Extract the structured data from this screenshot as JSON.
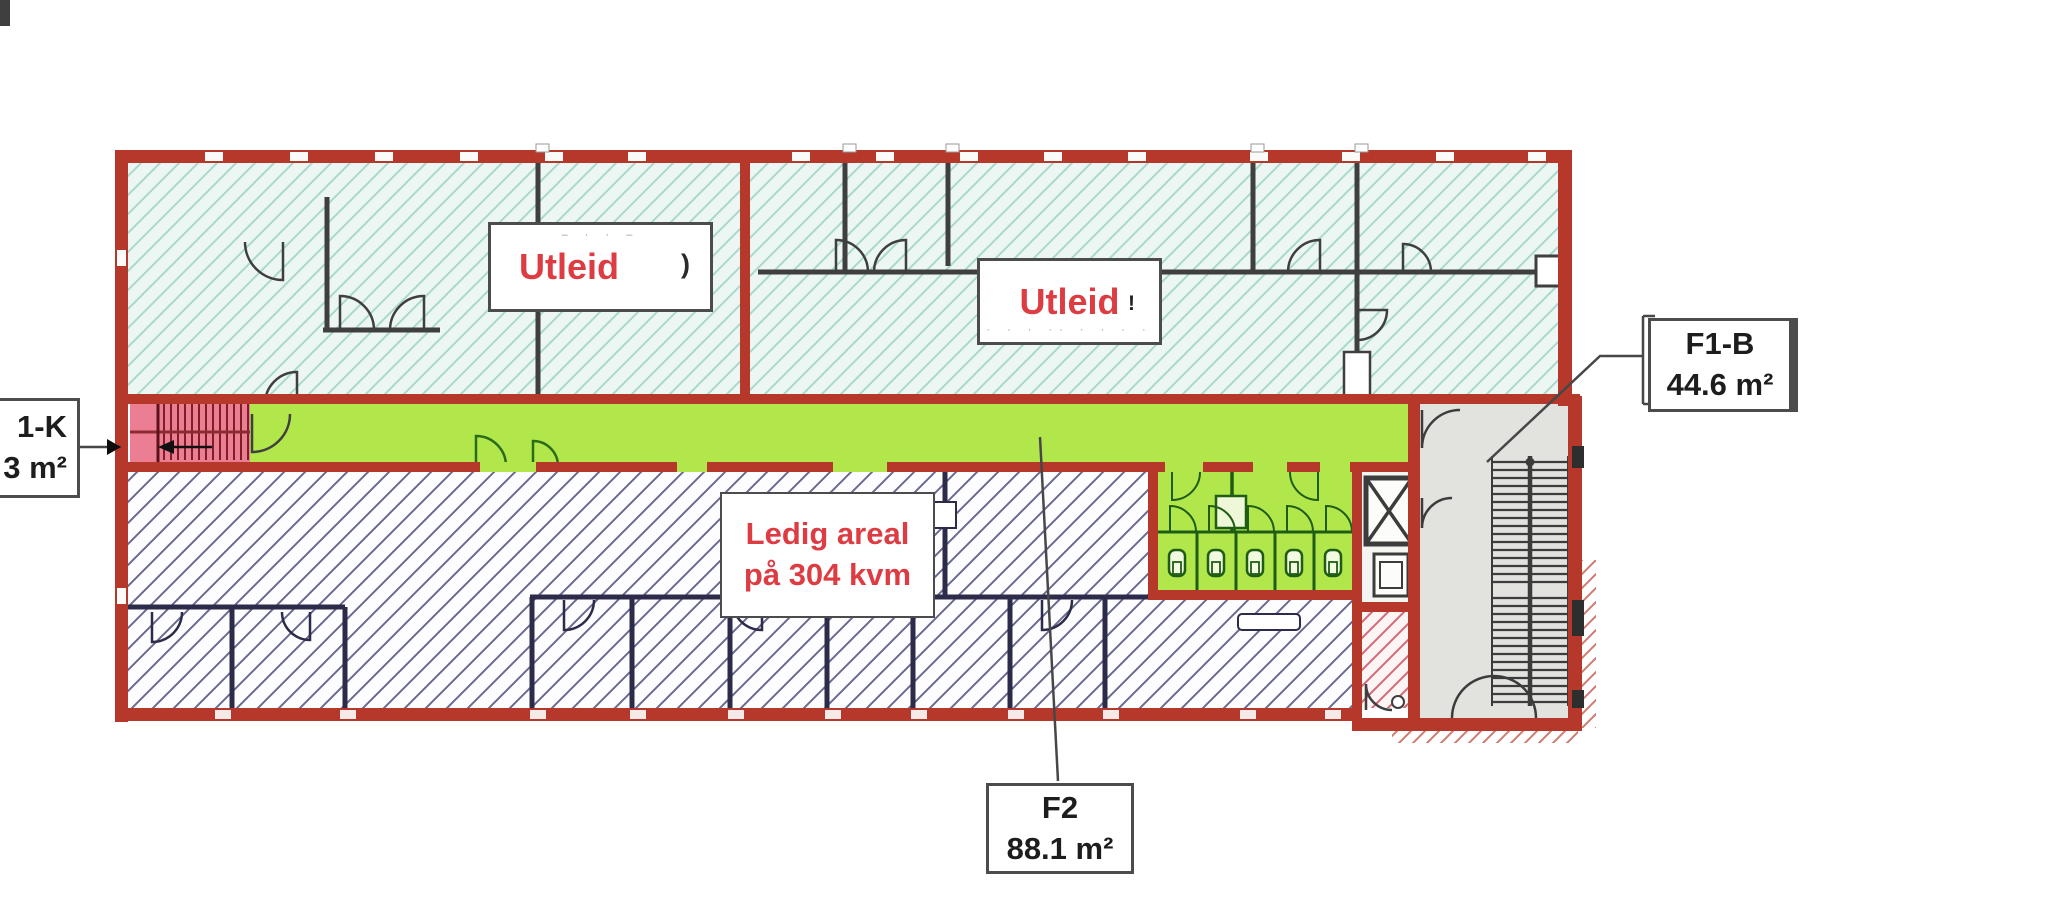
{
  "floor_plan": {
    "leased_label_1": {
      "text": "Utleid",
      "remnant": ")",
      "erased_marks": "– ·         ·      –"
    },
    "leased_label_2": {
      "text": "Utleid",
      "remnant": "!",
      "erased_marks": "· ·   · ·· ·  · · ·"
    },
    "vacant_label": {
      "line1": "Ledig areal",
      "line2": "på 304 kvm"
    },
    "unit_f1k": {
      "name_fragment": "1-K",
      "area_fragment": "3 m²"
    },
    "unit_f1b": {
      "name": "F1-B",
      "area": "44.6 m²"
    },
    "unit_f2": {
      "name": "F2",
      "area": "88.1 m²"
    },
    "colors": {
      "outer_wall_red": "#b5382b",
      "corridor_green": "#b2e74c",
      "leased_hatch_bg": "#ecf7f3",
      "leased_hatch_line": "#a9d8cd",
      "vacant_hatch_line": "#6a6a90",
      "stair_block_pink": "#ec7e93",
      "stairwell_gray": "#e2e2df",
      "label_red_text": "#dd3c42"
    }
  }
}
